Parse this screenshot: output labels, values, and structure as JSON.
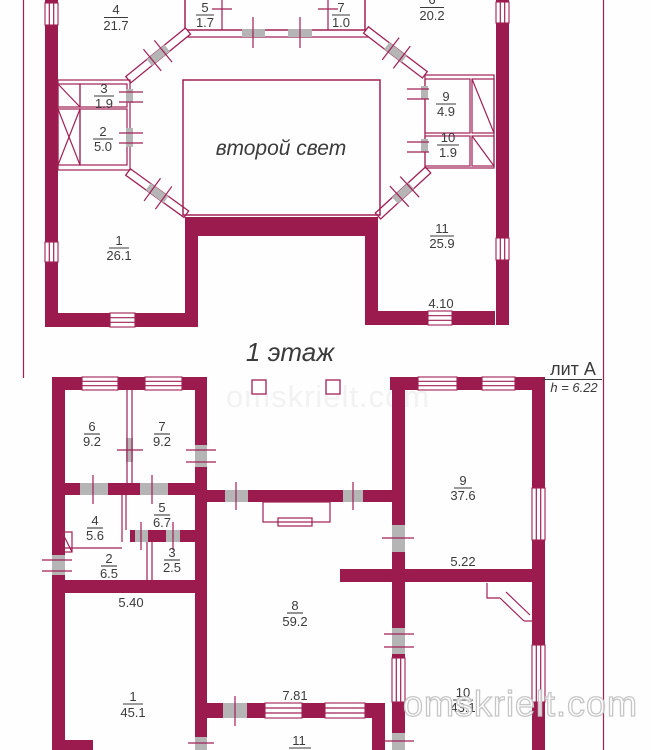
{
  "colors": {
    "wall": "#9c1b4e",
    "thin_line": "#a02055",
    "door_opening": "#b5b5b5",
    "text": "#3b3b3b",
    "watermark": "#c6c6c6",
    "background": "#fefefe"
  },
  "upper": {
    "atrium": "второй свет",
    "rooms": [
      {
        "num": "4",
        "area": "21.7"
      },
      {
        "num": "5",
        "area": "1.7"
      },
      {
        "num": "7",
        "area": "1.0"
      },
      {
        "num": "6",
        "area": "20.2"
      },
      {
        "num": "3",
        "area": "1.9"
      },
      {
        "num": "2",
        "area": "5.0"
      },
      {
        "num": "9",
        "area": "4.9"
      },
      {
        "num": "10",
        "area": "1.9"
      },
      {
        "num": "1",
        "area": "26.1"
      },
      {
        "num": "11",
        "area": "25.9"
      }
    ],
    "dim": "4.10"
  },
  "middle": {
    "floor": "1 этаж",
    "liter": "лит А",
    "height": "h = 6.22"
  },
  "lower": {
    "rooms": [
      {
        "num": "6",
        "area": "9.2"
      },
      {
        "num": "7",
        "area": "9.2"
      },
      {
        "num": "4",
        "area": "5.6"
      },
      {
        "num": "5",
        "area": "6.7"
      },
      {
        "num": "2",
        "area": "6.5"
      },
      {
        "num": "3",
        "area": "2.5"
      },
      {
        "num": "8",
        "area": "59.2"
      },
      {
        "num": "9",
        "area": "37.6"
      },
      {
        "num": "1",
        "area": "45.1"
      },
      {
        "num": "10",
        "area": "43.1"
      },
      {
        "num": "11",
        "area": "15.6"
      }
    ],
    "dims": {
      "top_left": "5.40",
      "right": "5.22",
      "bottom": "7.81"
    }
  },
  "watermark": "omskrielt.com"
}
